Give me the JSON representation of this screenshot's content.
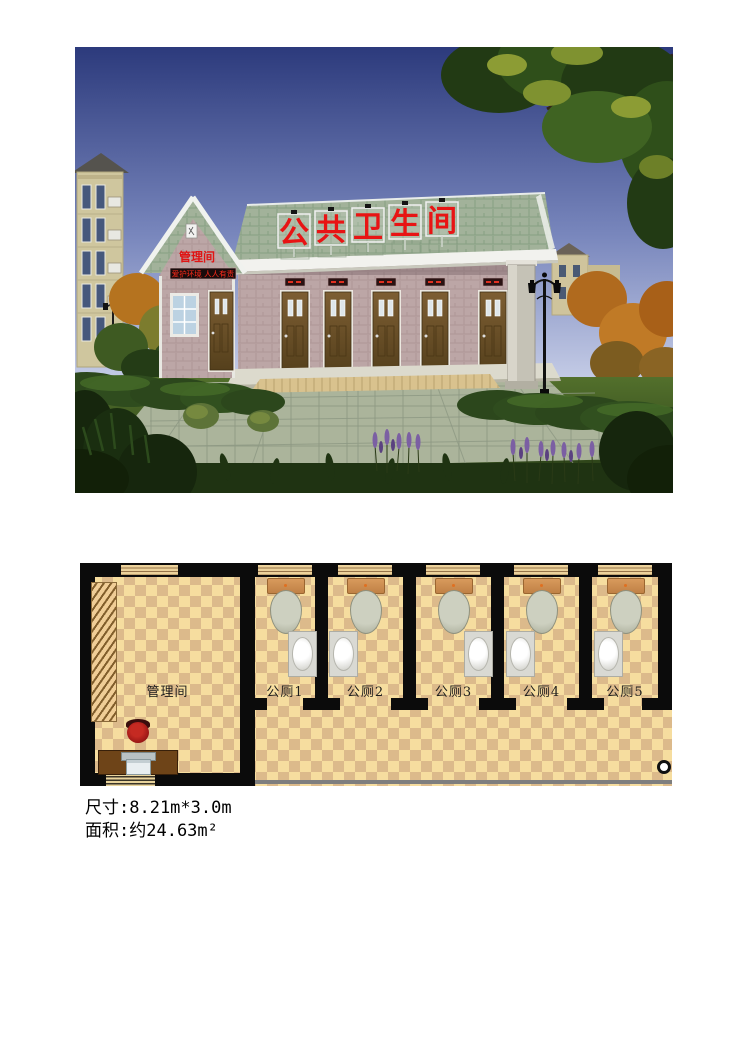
{
  "rendering": {
    "roof_sign_text": "公共卫生间",
    "roof_sign_chars": [
      "公",
      "共",
      "卫",
      "生",
      "间"
    ],
    "gable_label": "管理间",
    "led_banner_text": "爱护环境 人人有责",
    "colors": {
      "sky_top": "#2c3a7c",
      "sky_bottom": "#c8cfe8",
      "roof_green": "#a2b29a",
      "wall_pink": "#bca6a6",
      "door_brown": "#6a5228",
      "sign_red": "#e81414",
      "plaza": "#abb49b",
      "grass": "#3f5a25"
    }
  },
  "floor_plan": {
    "management_room_label": "管理间",
    "stall_labels": [
      "公厕1",
      "公厕2",
      "公厕3",
      "公厕4",
      "公厕5"
    ],
    "colors": {
      "wall": "#0b0b0b",
      "floor_light": "#f6dd9f",
      "floor_dark": "#dcba8b"
    }
  },
  "specs": {
    "size_line": "尺寸:8.21m*3.0m",
    "area_line": "面积:约24.63m²"
  }
}
